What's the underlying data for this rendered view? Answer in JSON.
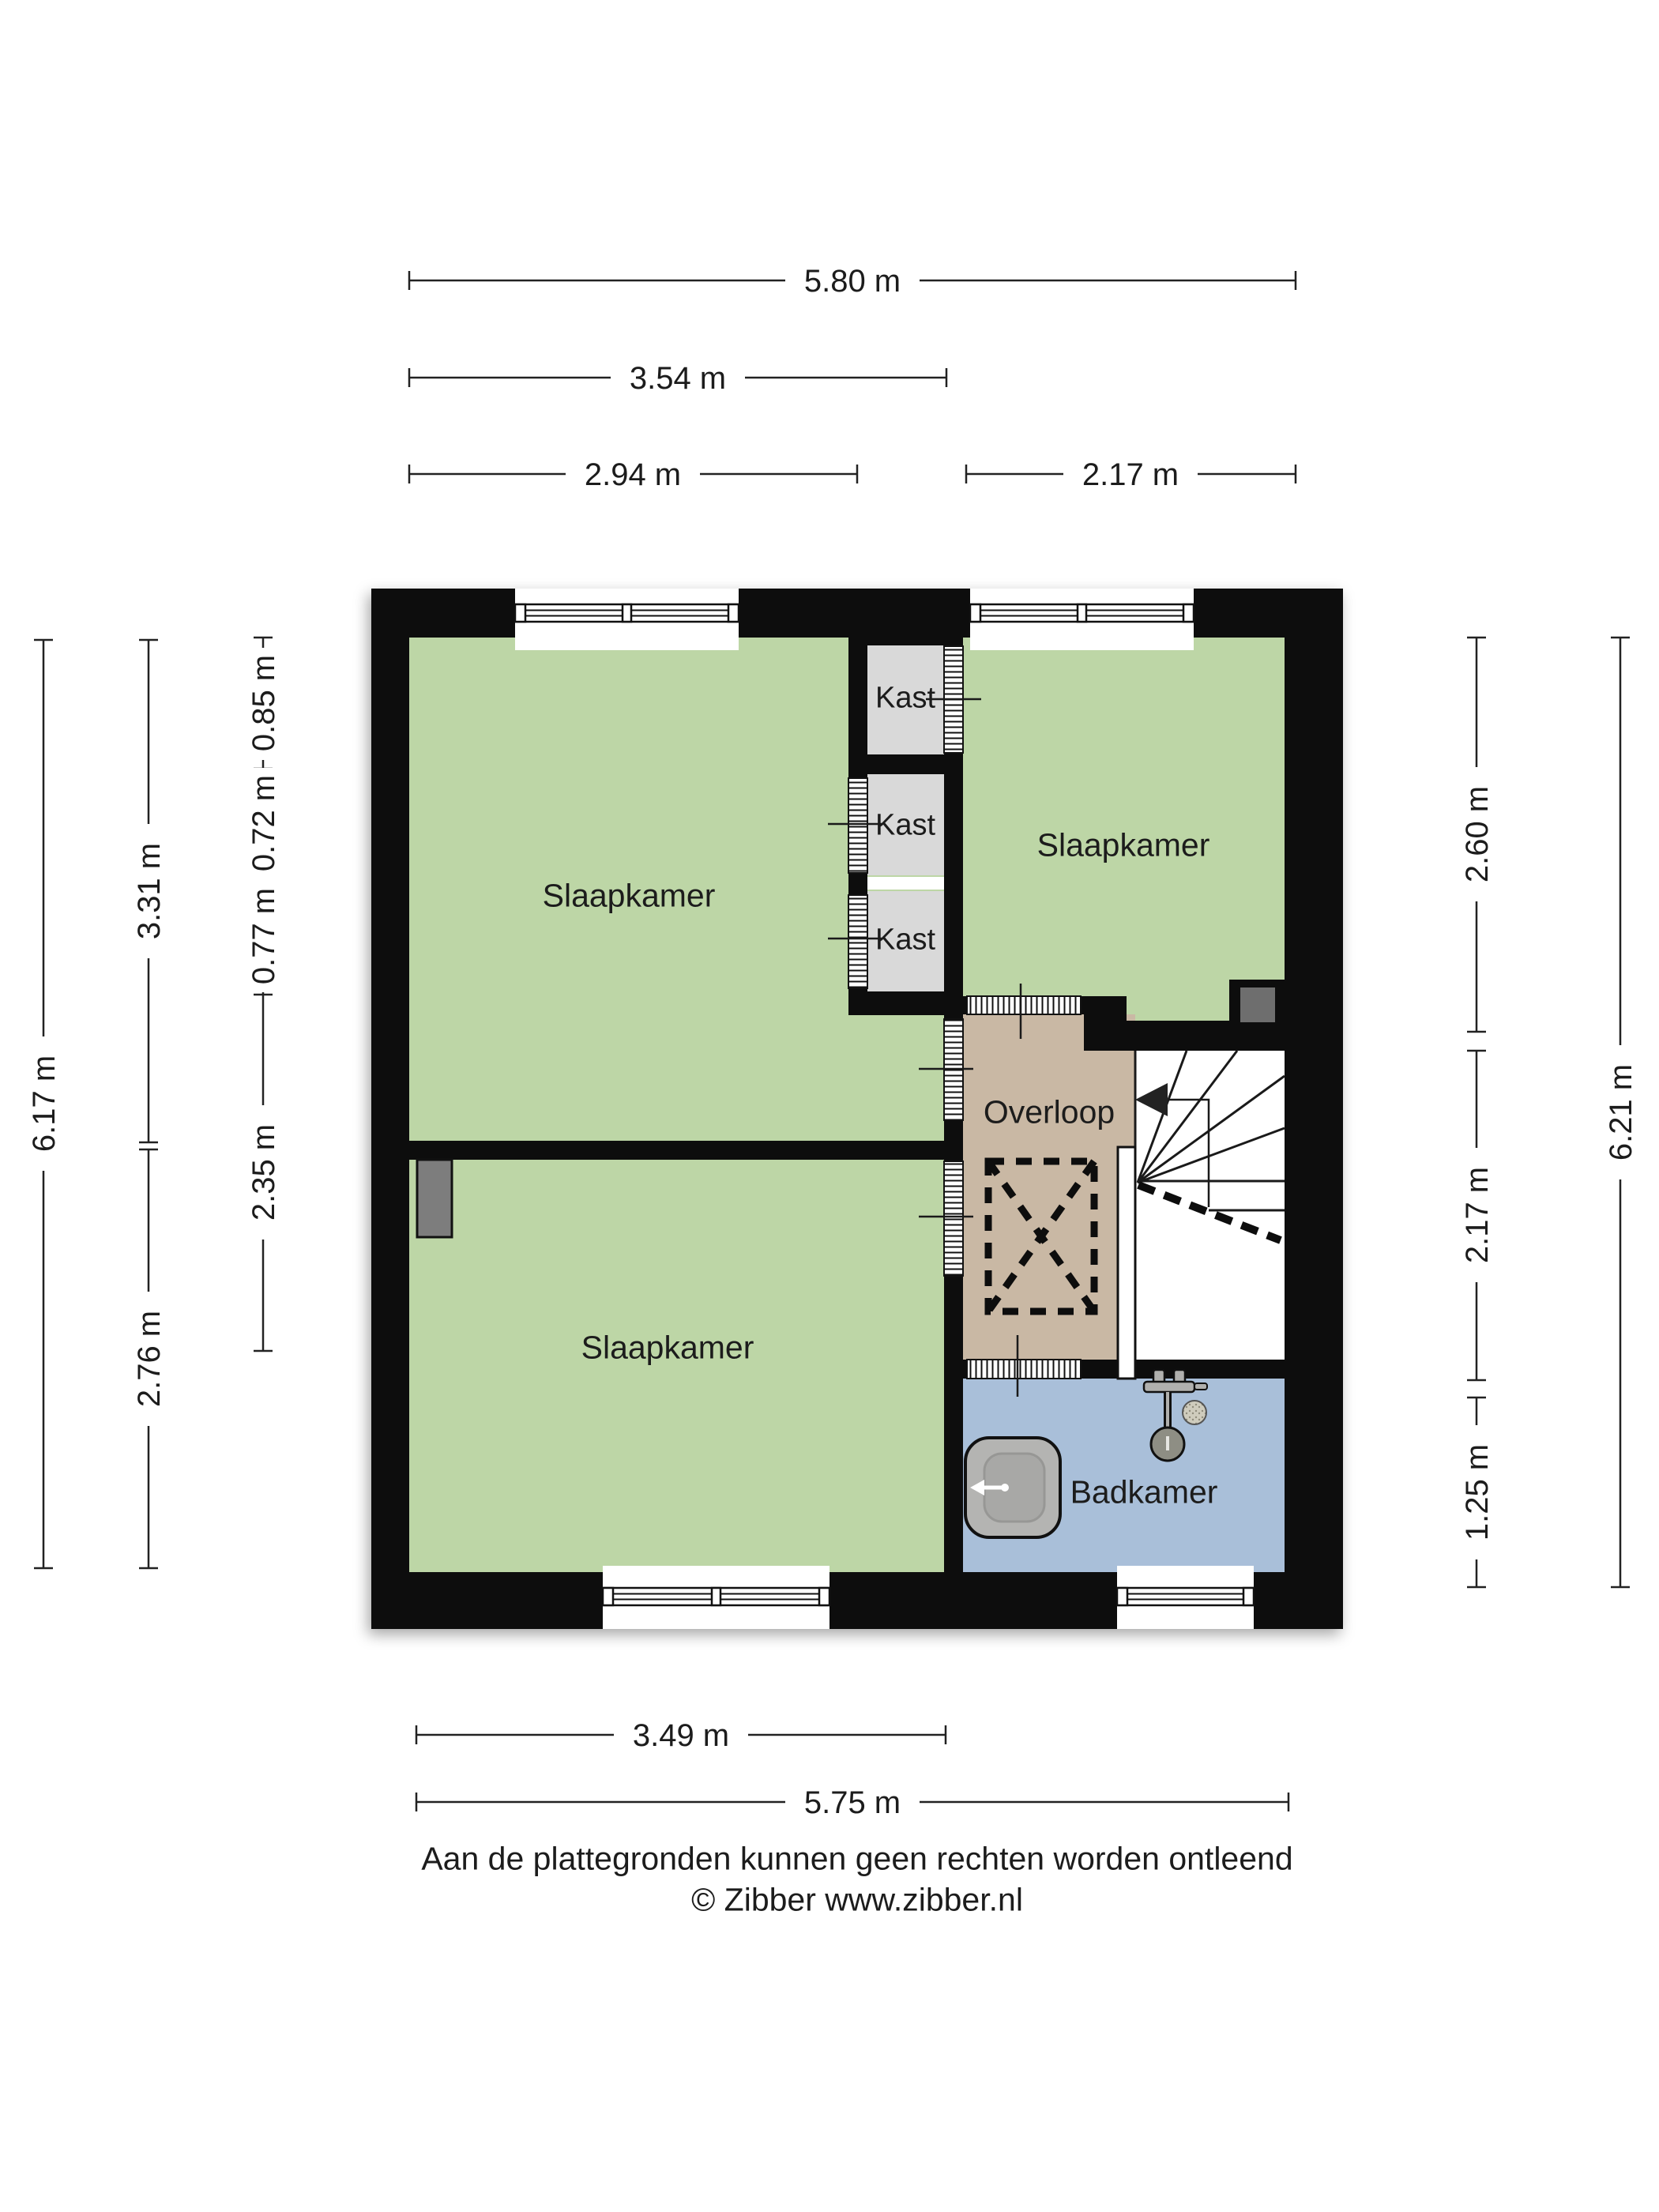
{
  "rooms": {
    "slaapkamer_tl": "Slaapkamer",
    "slaapkamer_tr": "Slaapkamer",
    "slaapkamer_bl": "Slaapkamer",
    "kast_1": "Kast",
    "kast_2": "Kast",
    "kast_3": "Kast",
    "overloop": "Overloop",
    "badkamer": "Badkamer"
  },
  "dims": {
    "top_full": "5.80 m",
    "top_mid": "3.54 m",
    "top_left": "2.94 m",
    "top_right": "2.17 m",
    "left_outer": "6.17 m",
    "left_upper": "3.31 m",
    "left_lower": "2.76 m",
    "kast_top": "0.85 m",
    "kast_mid": "0.72 m",
    "kast_bottom": "0.77 m",
    "left_inner": "2.35 m",
    "right_top": "2.60 m",
    "right_mid": "2.17 m",
    "right_bottom": "1.25 m",
    "right_outer": "6.21 m",
    "bottom_left": "3.49 m",
    "bottom_full": "5.75 m"
  },
  "footer": {
    "disclaimer": "Aan de plattegronden kunnen geen rechten worden ontleend",
    "copyright": "© Zibber www.zibber.nl"
  },
  "colors": {
    "wall": "#0d0d0d",
    "bedroom": "#bdd6a6",
    "closet": "#d9d9d9",
    "hallway": "#c9b8a4",
    "bathroom": "#a9bfd9",
    "chimney": "#6e6e6e",
    "fixture": "#8e8e84",
    "text": "#1c1c1c"
  }
}
